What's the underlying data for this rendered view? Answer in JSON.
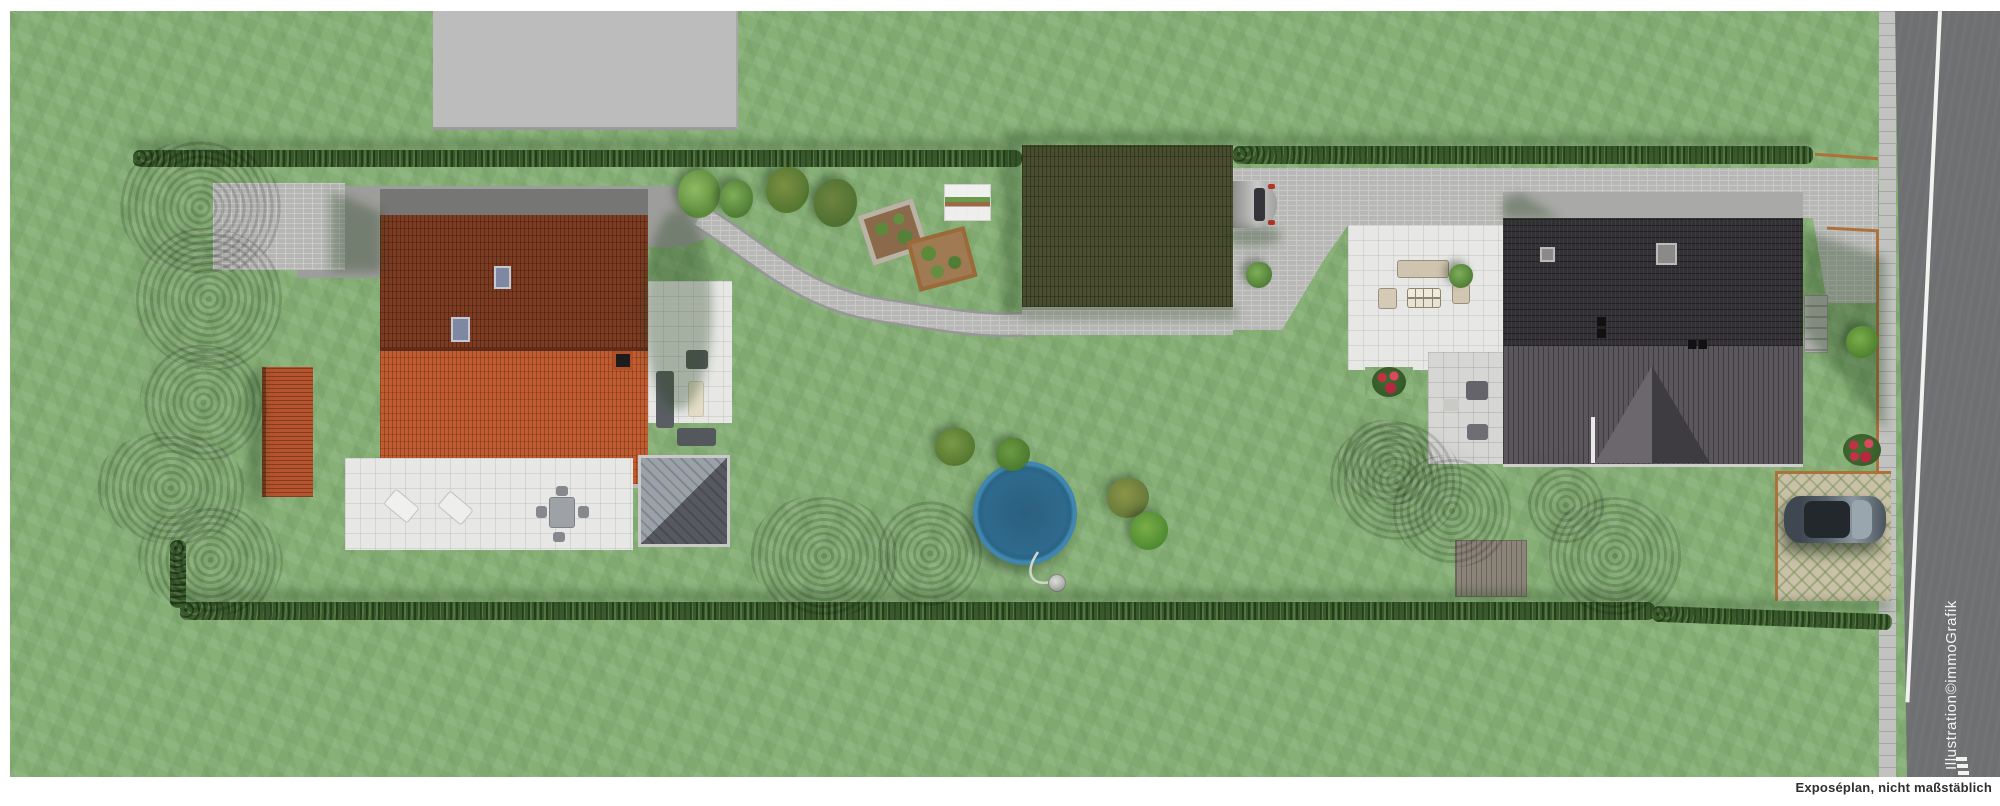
{
  "annotations": {
    "watermark": "Illustration©immoGrafik",
    "disclaimer": "Exposéplan, nicht maßstäblich"
  },
  "scene": {
    "type": "aerial-site-plan",
    "description": "Top-down real-estate exposé plan of an elongated plot with two houses, garage, garden and street",
    "objects": [
      "neighbor-building",
      "left-house-red-roof",
      "garden-shed-red",
      "courtyard-pavers",
      "garden-path",
      "east-patio-lounge",
      "south-terrace-dining",
      "dark-wood-deck",
      "vegetable-bed-stone",
      "vegetable-bed-wood",
      "cold-frame",
      "green-roof-garage",
      "silver-car",
      "driveway",
      "round-pool",
      "pool-pump",
      "right-house-dark-roof",
      "west-patio-lounge",
      "rose-bed",
      "outdoor-stairs",
      "wood-deck-patch",
      "parking-pad-grass-pavers",
      "dark-parked-car",
      "street",
      "hedges",
      "trees"
    ]
  },
  "palette": {
    "lawn": "#87b077",
    "hedge": "#3a5a2d",
    "red_roof_bright": "#c05c30",
    "red_roof_dark": "#7d3b22",
    "anthracite_roof_dark": "#323034",
    "anthracite_roof_light": "#5a565c",
    "garage_green_roof": "#4b4f30",
    "pavers": "#b6b6b4",
    "white_tiles": "#e7e7e5",
    "road_asphalt": "#6e7071",
    "pool_rim": "#4088b0",
    "pool_water": "#2e6a8c",
    "parking_pad": "#c9c0a8",
    "fence": "#ad713a",
    "page_background": "#ffffff"
  }
}
